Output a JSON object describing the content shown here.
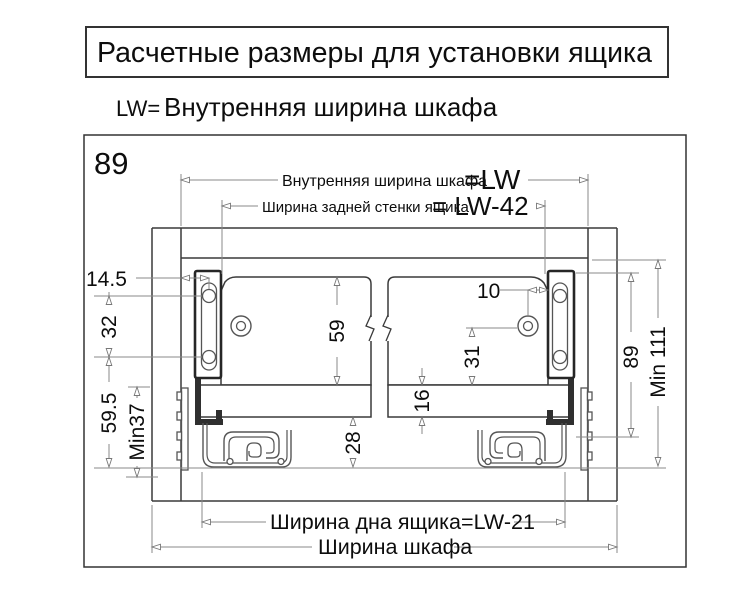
{
  "title": "Расчетные размеры для установки ящика",
  "subtitle": {
    "lw": "LW=",
    "text": "Внутренняя ширина шкафа"
  },
  "diagram": {
    "corner": "89",
    "dim_top1": {
      "label": "Внутренняя ширина шкафа",
      "value": "=LW"
    },
    "dim_top2": {
      "label": "Ширина задней стенки ящика",
      "value": "= LW-42"
    },
    "dim_bottom1": "Ширина дна ящика=LW-21",
    "dim_bottom2": "Ширина шкафа",
    "dims": {
      "d14_5": "14.5",
      "d32": "32",
      "d59_5": "59.5",
      "dmin37": "Min37",
      "d59": "59",
      "d16": "16",
      "d28": "28",
      "d10": "10",
      "d31": "31",
      "d89": "89",
      "dmin111": "Min 111"
    }
  },
  "colors": {
    "ink": "#3a3a3a",
    "dim_line": "#8a8a8a",
    "bracket": "#262626",
    "text": "#0d0d0d"
  }
}
